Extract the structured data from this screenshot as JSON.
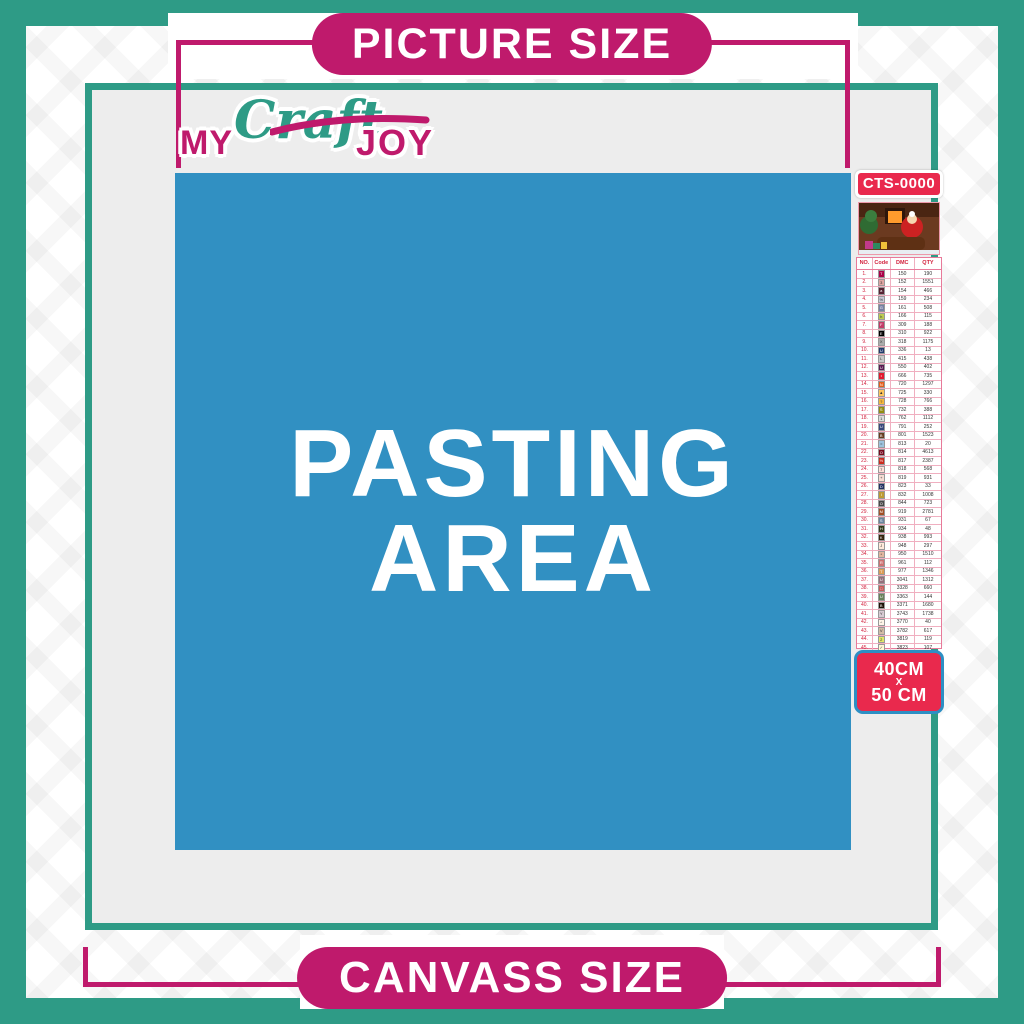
{
  "banners": {
    "top": "PICTURE SIZE",
    "bottom": "CANVASS SIZE"
  },
  "logo": {
    "my": "MY",
    "craft": "Craft",
    "joy": "JOY"
  },
  "pasting_area": {
    "line1": "PASTING",
    "line2": "AREA"
  },
  "product": {
    "code": "CTS-0000",
    "size_line1": "40CM",
    "size_sep": "X",
    "size_line2": "50 CM",
    "thumbnail": "christmas-santa-sleigh-scene"
  },
  "colors": {
    "teal": "#2E9B86",
    "magenta": "#BF1A6C",
    "pasting_blue": "#3190C2",
    "badge_red": "#E9294D",
    "badge_blue_border": "#2D8FC4",
    "content_gray": "#EDEDED"
  },
  "color_chart": {
    "headers": [
      "NO.",
      "Code",
      "DMC",
      "QTY"
    ],
    "rows": [
      {
        "no": "1.",
        "sym": "T",
        "bg": "#AB0249",
        "fg": "#fff",
        "dmc": "150",
        "qty": "190"
      },
      {
        "no": "2.",
        "sym": "3",
        "bg": "#E0A5A2",
        "fg": "#333",
        "dmc": "152",
        "qty": "1551"
      },
      {
        "no": "3.",
        "sym": "a",
        "bg": "#572433",
        "fg": "#fff",
        "dmc": "154",
        "qty": "466"
      },
      {
        "no": "4.",
        "sym": "%",
        "bg": "#C7CAD7",
        "fg": "#333",
        "dmc": "159",
        "qty": "234"
      },
      {
        "no": "5.",
        "sym": "G",
        "bg": "#7880A4",
        "fg": "#fff",
        "dmc": "161",
        "qty": "508"
      },
      {
        "no": "6.",
        "sym": "h",
        "bg": "#BDCC51",
        "fg": "#333",
        "dmc": "166",
        "qty": "115"
      },
      {
        "no": "7.",
        "sym": "F",
        "bg": "#C23B68",
        "fg": "#fff",
        "dmc": "309",
        "qty": "188"
      },
      {
        "no": "8.",
        "sym": "E",
        "bg": "#000000",
        "fg": "#fff",
        "dmc": "310",
        "qty": "922"
      },
      {
        "no": "9.",
        "sym": "X",
        "bg": "#ABACAC",
        "fg": "#333",
        "dmc": "318",
        "qty": "1175"
      },
      {
        "no": "10.",
        "sym": "U",
        "bg": "#243A6E",
        "fg": "#fff",
        "dmc": "336",
        "qty": "13"
      },
      {
        "no": "11.",
        "sym": "L",
        "bg": "#C8C8C8",
        "fg": "#333",
        "dmc": "415",
        "qty": "438"
      },
      {
        "no": "12.",
        "sym": "U",
        "bg": "#5B1A51",
        "fg": "#fff",
        "dmc": "550",
        "qty": "402"
      },
      {
        "no": "13.",
        "sym": "•",
        "bg": "#E3172C",
        "fg": "#fff",
        "dmc": "666",
        "qty": "735"
      },
      {
        "no": "14.",
        "sym": "N",
        "bg": "#E55E1E",
        "fg": "#fff",
        "dmc": "720",
        "qty": "1297"
      },
      {
        "no": "15.",
        "sym": "▲",
        "bg": "#FFC65C",
        "fg": "#333",
        "dmc": "725",
        "qty": "330"
      },
      {
        "no": "16.",
        "sym": "?",
        "bg": "#F5B73D",
        "fg": "#333",
        "dmc": "728",
        "qty": "766"
      },
      {
        "no": "17.",
        "sym": "S",
        "bg": "#948C10",
        "fg": "#fff",
        "dmc": "732",
        "qty": "388"
      },
      {
        "no": "18.",
        "sym": "1",
        "bg": "#DCDCDC",
        "fg": "#333",
        "dmc": "762",
        "qty": "1112"
      },
      {
        "no": "19.",
        "sym": "U",
        "bg": "#39477C",
        "fg": "#fff",
        "dmc": "791",
        "qty": "252"
      },
      {
        "no": "20.",
        "sym": "B",
        "bg": "#653C1F",
        "fg": "#fff",
        "dmc": "801",
        "qty": "1523"
      },
      {
        "no": "21.",
        "sym": "=",
        "bg": "#9CC3DD",
        "fg": "#333",
        "dmc": "813",
        "qty": "20"
      },
      {
        "no": "22.",
        "sym": "O",
        "bg": "#770A1E",
        "fg": "#fff",
        "dmc": "814",
        "qty": "4613"
      },
      {
        "no": "23.",
        "sym": "½",
        "bg": "#CC2A1E",
        "fg": "#fff",
        "dmc": "817",
        "qty": "2387"
      },
      {
        "no": "24.",
        "sym": "7",
        "bg": "#FFDFD9",
        "fg": "#333",
        "dmc": "818",
        "qty": "568"
      },
      {
        "no": "25.",
        "sym": "+",
        "bg": "#F7DCD4",
        "fg": "#333",
        "dmc": "819",
        "qty": "931"
      },
      {
        "no": "26.",
        "sym": "D",
        "bg": "#213063",
        "fg": "#fff",
        "dmc": "823",
        "qty": "33"
      },
      {
        "no": "27.",
        "sym": "I",
        "bg": "#BD9B33",
        "fg": "#fff",
        "dmc": "832",
        "qty": "1008"
      },
      {
        "no": "28.",
        "sym": "O",
        "bg": "#484848",
        "fg": "#fff",
        "dmc": "844",
        "qty": "723"
      },
      {
        "no": "29.",
        "sym": "M",
        "bg": "#A14F25",
        "fg": "#fff",
        "dmc": "919",
        "qty": "2781"
      },
      {
        "no": "30.",
        "sym": "S",
        "bg": "#6A84A0",
        "fg": "#fff",
        "dmc": "931",
        "qty": "67"
      },
      {
        "no": "31.",
        "sym": "H",
        "bg": "#313919",
        "fg": "#fff",
        "dmc": "934",
        "qty": "48"
      },
      {
        "no": "32.",
        "sym": "K",
        "bg": "#36220C",
        "fg": "#fff",
        "dmc": "938",
        "qty": "993"
      },
      {
        "no": "33.",
        "sym": "J",
        "bg": "#FEE9DA",
        "fg": "#333",
        "dmc": "948",
        "qty": "297"
      },
      {
        "no": "34.",
        "sym": "*",
        "bg": "#E1B69F",
        "fg": "#333",
        "dmc": "950",
        "qty": "1510"
      },
      {
        "no": "35.",
        "sym": "R",
        "bg": "#CF7373",
        "fg": "#fff",
        "dmc": "961",
        "qty": "112"
      },
      {
        "no": "36.",
        "sym": "T",
        "bg": "#DC9C56",
        "fg": "#fff",
        "dmc": "977",
        "qty": "1346"
      },
      {
        "no": "37.",
        "sym": "U",
        "bg": "#956F7C",
        "fg": "#fff",
        "dmc": "3041",
        "qty": "1312"
      },
      {
        "no": "38.",
        "sym": "□",
        "bg": "#C65B5B",
        "fg": "#fff",
        "dmc": "3328",
        "qty": "660"
      },
      {
        "no": "39.",
        "sym": "U",
        "bg": "#68825B",
        "fg": "#fff",
        "dmc": "3363",
        "qty": "144"
      },
      {
        "no": "40.",
        "sym": "B",
        "bg": "#1E1108",
        "fg": "#fff",
        "dmc": "3371",
        "qty": "1680"
      },
      {
        "no": "41.",
        "sym": "Y",
        "bg": "#D7CBD3",
        "fg": "#333",
        "dmc": "3743",
        "qty": "1738"
      },
      {
        "no": "42.",
        "sym": "^",
        "bg": "#FFF6E9",
        "fg": "#333",
        "dmc": "3770",
        "qty": "40"
      },
      {
        "no": "43.",
        "sym": "V",
        "bg": "#D2BCA6",
        "fg": "#333",
        "dmc": "3782",
        "qty": "617"
      },
      {
        "no": "44.",
        "sym": "2",
        "bg": "#E0E868",
        "fg": "#333",
        "dmc": "3819",
        "qty": "119"
      },
      {
        "no": "45.",
        "sym": "✓",
        "bg": "#FFF9D5",
        "fg": "#333",
        "dmc": "3823",
        "qty": "107"
      },
      {
        "no": "46.",
        "sym": "C",
        "bg": "#F29746",
        "fg": "#333",
        "dmc": "3853",
        "qty": "1332"
      },
      {
        "no": "47.",
        "sym": "W",
        "bg": "#7E4A41",
        "fg": "#fff",
        "dmc": "3858",
        "qty": "2311"
      },
      {
        "no": "48.",
        "sym": "A",
        "bg": "#A4835C",
        "fg": "#fff",
        "dmc": "3863",
        "qty": "1820"
      }
    ]
  }
}
